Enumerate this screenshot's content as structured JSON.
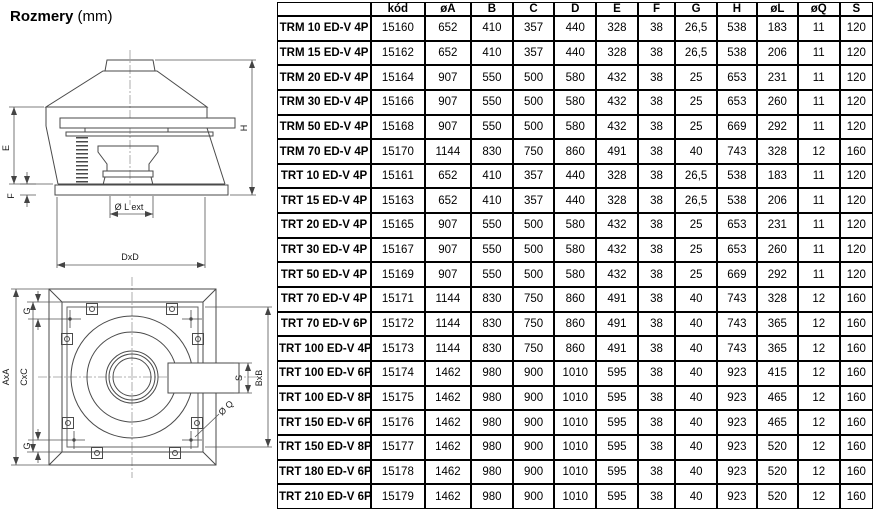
{
  "title": {
    "main": "Rozmery",
    "unit": "(mm)"
  },
  "drawing": {
    "side": {
      "e": "E",
      "f": "F",
      "h": "H",
      "l_ext": "Ø L  ext",
      "dxd": "DxD"
    },
    "top": {
      "axa": "AxA",
      "cxc": "CxC",
      "g_top": "G",
      "g_bottom": "G",
      "bxb": "BxB",
      "s": "S",
      "q": "Ø Q"
    }
  },
  "table": {
    "columns": [
      "",
      "kód",
      "øA",
      "B",
      "C",
      "D",
      "E",
      "F",
      "G",
      "H",
      "øL",
      "øQ",
      "S"
    ],
    "rows": [
      {
        "name": "TRM 10 ED-V 4P",
        "values": [
          "15160",
          "652",
          "410",
          "357",
          "440",
          "328",
          "38",
          "26,5",
          "538",
          "183",
          "11",
          "120"
        ]
      },
      {
        "name": "TRM 15 ED-V 4P",
        "values": [
          "15162",
          "652",
          "410",
          "357",
          "440",
          "328",
          "38",
          "26,5",
          "538",
          "206",
          "11",
          "120"
        ]
      },
      {
        "name": "TRM 20 ED-V 4P",
        "values": [
          "15164",
          "907",
          "550",
          "500",
          "580",
          "432",
          "38",
          "25",
          "653",
          "231",
          "11",
          "120"
        ]
      },
      {
        "name": "TRM 30 ED-V 4P",
        "values": [
          "15166",
          "907",
          "550",
          "500",
          "580",
          "432",
          "38",
          "25",
          "653",
          "260",
          "11",
          "120"
        ]
      },
      {
        "name": "TRM 50 ED-V 4P",
        "values": [
          "15168",
          "907",
          "550",
          "500",
          "580",
          "432",
          "38",
          "25",
          "669",
          "292",
          "11",
          "120"
        ]
      },
      {
        "name": "TRM 70 ED-V 4P",
        "values": [
          "15170",
          "1144",
          "830",
          "750",
          "860",
          "491",
          "38",
          "40",
          "743",
          "328",
          "12",
          "160"
        ]
      },
      {
        "name": "TRT 10 ED-V 4P",
        "values": [
          "15161",
          "652",
          "410",
          "357",
          "440",
          "328",
          "38",
          "26,5",
          "538",
          "183",
          "11",
          "120"
        ]
      },
      {
        "name": "TRT 15 ED-V 4P",
        "values": [
          "15163",
          "652",
          "410",
          "357",
          "440",
          "328",
          "38",
          "26,5",
          "538",
          "206",
          "11",
          "120"
        ]
      },
      {
        "name": "TRT 20 ED-V 4P",
        "values": [
          "15165",
          "907",
          "550",
          "500",
          "580",
          "432",
          "38",
          "25",
          "653",
          "231",
          "11",
          "120"
        ]
      },
      {
        "name": "TRT 30 ED-V 4P",
        "values": [
          "15167",
          "907",
          "550",
          "500",
          "580",
          "432",
          "38",
          "25",
          "653",
          "260",
          "11",
          "120"
        ]
      },
      {
        "name": "TRT 50 ED-V 4P",
        "values": [
          "15169",
          "907",
          "550",
          "500",
          "580",
          "432",
          "38",
          "25",
          "669",
          "292",
          "11",
          "120"
        ]
      },
      {
        "name": "TRT 70 ED-V 4P",
        "values": [
          "15171",
          "1144",
          "830",
          "750",
          "860",
          "491",
          "38",
          "40",
          "743",
          "328",
          "12",
          "160"
        ]
      },
      {
        "name": "TRT 70 ED-V 6P",
        "values": [
          "15172",
          "1144",
          "830",
          "750",
          "860",
          "491",
          "38",
          "40",
          "743",
          "365",
          "12",
          "160"
        ]
      },
      {
        "name": "TRT 100 ED-V 4P",
        "values": [
          "15173",
          "1144",
          "830",
          "750",
          "860",
          "491",
          "38",
          "40",
          "743",
          "365",
          "12",
          "160"
        ]
      },
      {
        "name": "TRT 100 ED-V 6P",
        "values": [
          "15174",
          "1462",
          "980",
          "900",
          "1010",
          "595",
          "38",
          "40",
          "923",
          "415",
          "12",
          "160"
        ]
      },
      {
        "name": "TRT 100 ED-V 8P",
        "values": [
          "15175",
          "1462",
          "980",
          "900",
          "1010",
          "595",
          "38",
          "40",
          "923",
          "465",
          "12",
          "160"
        ]
      },
      {
        "name": "TRT 150 ED-V 6P",
        "values": [
          "15176",
          "1462",
          "980",
          "900",
          "1010",
          "595",
          "38",
          "40",
          "923",
          "465",
          "12",
          "160"
        ]
      },
      {
        "name": "TRT 150 ED-V 8P",
        "values": [
          "15177",
          "1462",
          "980",
          "900",
          "1010",
          "595",
          "38",
          "40",
          "923",
          "520",
          "12",
          "160"
        ]
      },
      {
        "name": "TRT 180 ED-V 6P",
        "values": [
          "15178",
          "1462",
          "980",
          "900",
          "1010",
          "595",
          "38",
          "40",
          "923",
          "520",
          "12",
          "160"
        ]
      },
      {
        "name": "TRT 210 ED-V 6P",
        "values": [
          "15179",
          "1462",
          "980",
          "900",
          "1010",
          "595",
          "38",
          "40",
          "923",
          "520",
          "12",
          "160"
        ]
      }
    ]
  }
}
